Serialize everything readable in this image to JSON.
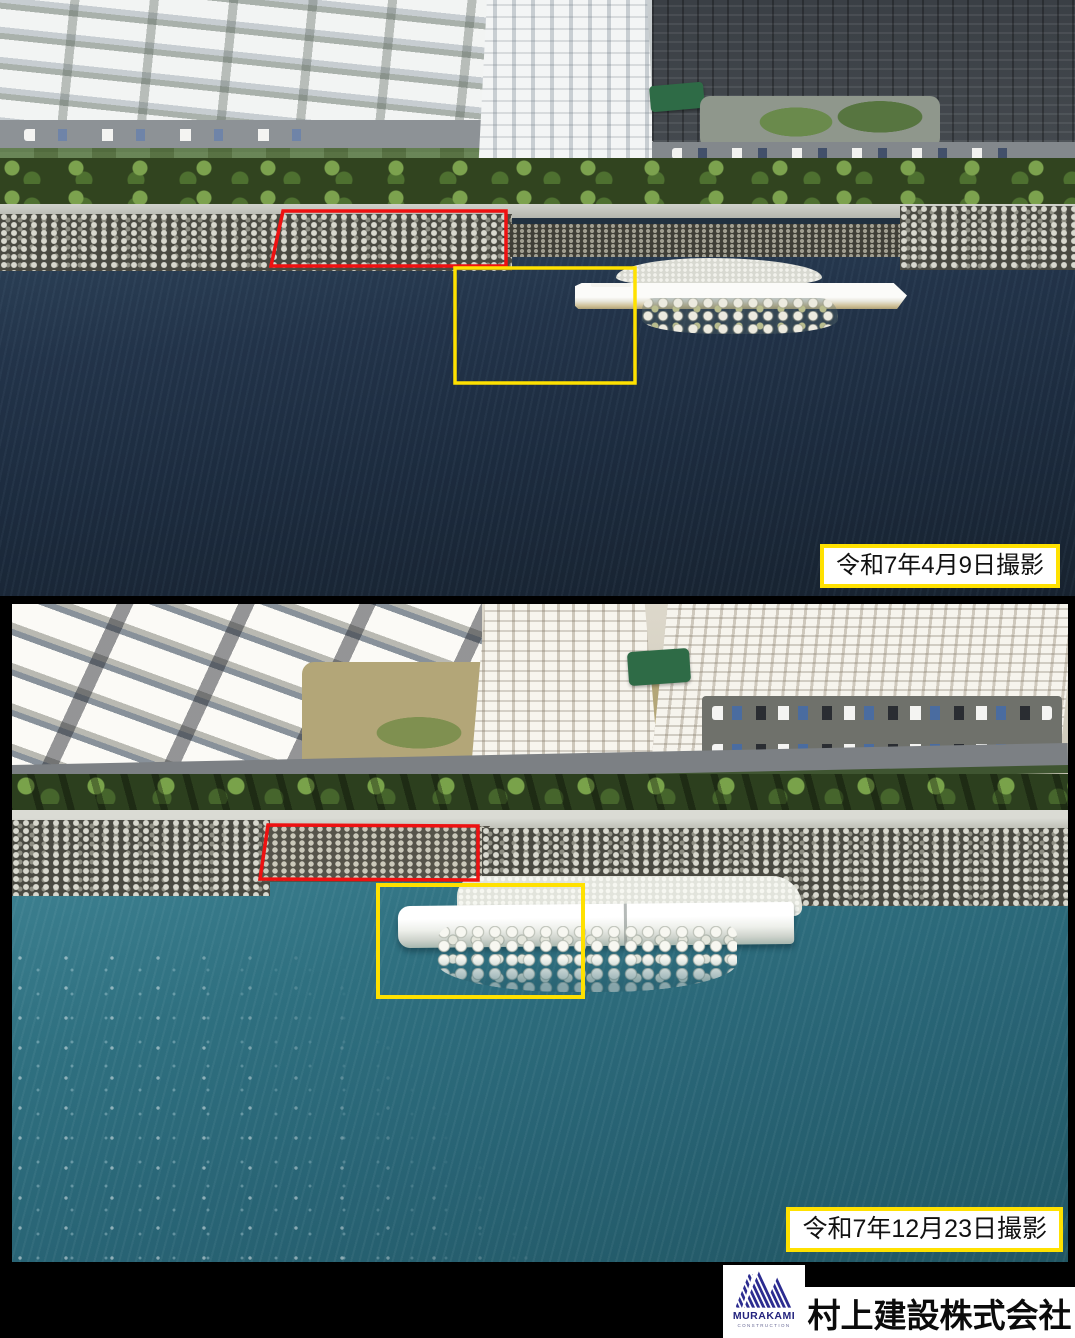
{
  "page": {
    "background": "#000000"
  },
  "photos": [
    {
      "id": "april",
      "caption": "令和7年4月9日撮影",
      "scene": "aerial view of coastal seawall with tetrapod revetment, dark navy sea, new breakwater caisson offshore, apartment blocks and buildings under renovation scaffolding on shore",
      "sea_color": "#1d2c3e",
      "annotations": [
        {
          "shape": "red-outline",
          "color": "#ee1111",
          "meaning": "tetrapod area before removal"
        },
        {
          "shape": "yellow-outline",
          "color": "#ffe100",
          "meaning": "open water area before breakwater extension"
        }
      ]
    },
    {
      "id": "december",
      "caption": "令和7年12月23日撮影",
      "scene": "aerial view of same coast in winter light, teal sea, extended breakwater caisson with new tetrapods, rubble slope where tetrapods were removed, renovated white apartment towers",
      "sea_color": "#2a6676",
      "annotations": [
        {
          "shape": "red-outline",
          "color": "#ee1111",
          "meaning": "rubble slope after tetrapod removal"
        },
        {
          "shape": "yellow-outline",
          "color": "#ffe100",
          "meaning": "extended breakwater with new tetrapods"
        }
      ]
    }
  ],
  "caption_style": {
    "background": "#ffffff",
    "border_color": "#ffe100",
    "text_color": "#111111"
  },
  "footer": {
    "logo_text": "MURAKAMI",
    "logo_sub": "CONSTRUCTION",
    "company_name": "村上建設株式会社",
    "logo_color": "#2c2c90"
  }
}
